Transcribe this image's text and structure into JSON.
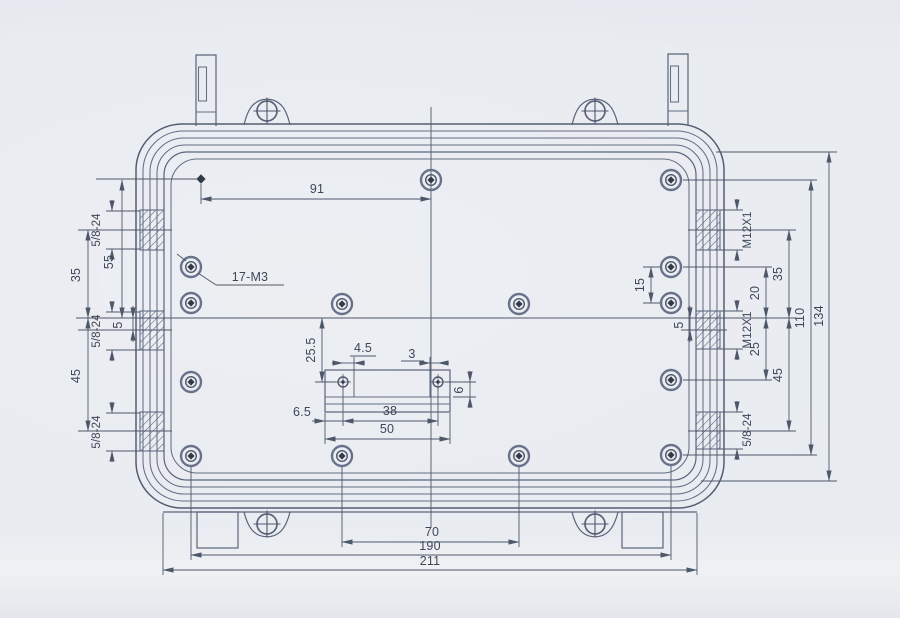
{
  "drawing": {
    "description": "Engineering dimension drawing of a rectangular enclosure base with mounting lugs, threaded bosses and screw holes",
    "colors": {
      "ink": "#4e586b",
      "paper": "#e8ebf0",
      "text": "#3e4759",
      "screw_center": "#333b4a"
    },
    "labels": {
      "dim_91": "91",
      "dim_55": "55",
      "dim_35_left": "35",
      "dim_5_left": "5",
      "dim_45_left": "45",
      "thread_left_top": "5/8-24",
      "thread_left_mid": "5/8-24",
      "thread_left_bot": "5/8-24",
      "leader_screw_count": "17-M3",
      "thread_right_top": "M12X1",
      "thread_right_mid": "M12X1",
      "thread_right_bot": "5/8-24",
      "dim_15": "15",
      "dim_5_right": "5",
      "dim_20": "20",
      "dim_25": "25",
      "dim_35_right": "35",
      "dim_45_right": "45",
      "dim_110": "110",
      "dim_134": "134",
      "dim_25_5": "25.5",
      "dim_4_5": "4.5",
      "dim_3": "3",
      "dim_6": "6",
      "dim_6_5": "6.5",
      "dim_38": "38",
      "dim_50": "50",
      "dim_70": "70",
      "dim_190": "190",
      "dim_211": "211"
    }
  }
}
